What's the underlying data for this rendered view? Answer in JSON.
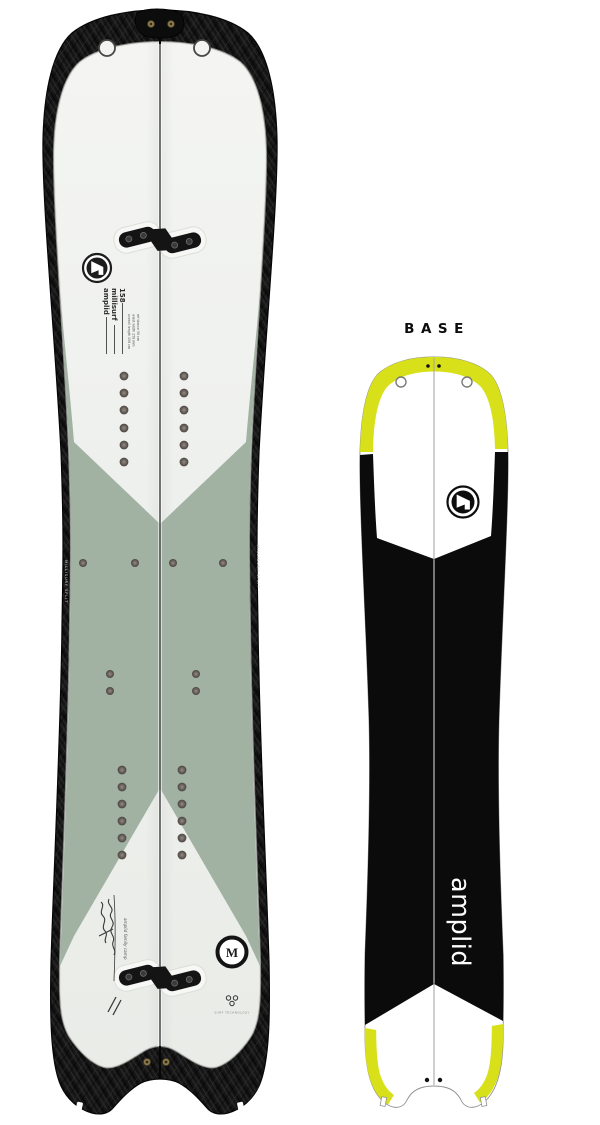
{
  "colors": {
    "background": "#ffffff",
    "carbon": "#161616",
    "topsheet_white": "#eff1ee",
    "sage_green": "#a1b2a3",
    "base_yellow": "#d7e018",
    "base_black": "#0b0b0b",
    "insert_dot": "#6e6660",
    "seam_line": "#3c3c3c"
  },
  "base_view": {
    "label": "BASE",
    "brand_text": "amplid"
  },
  "topsheet_view": {
    "brand": "amplid",
    "model": "millisurf",
    "size": "158",
    "spec_lines": [
      "overall length 158 cm",
      "waist width 258 mm",
      "ref stance 56 cm"
    ],
    "edge_text": "MILLISURF SPLIT",
    "handwriting": "amplid family camp",
    "badge_letter": "M",
    "tech_label": "SURF TECHNOLOGY"
  }
}
